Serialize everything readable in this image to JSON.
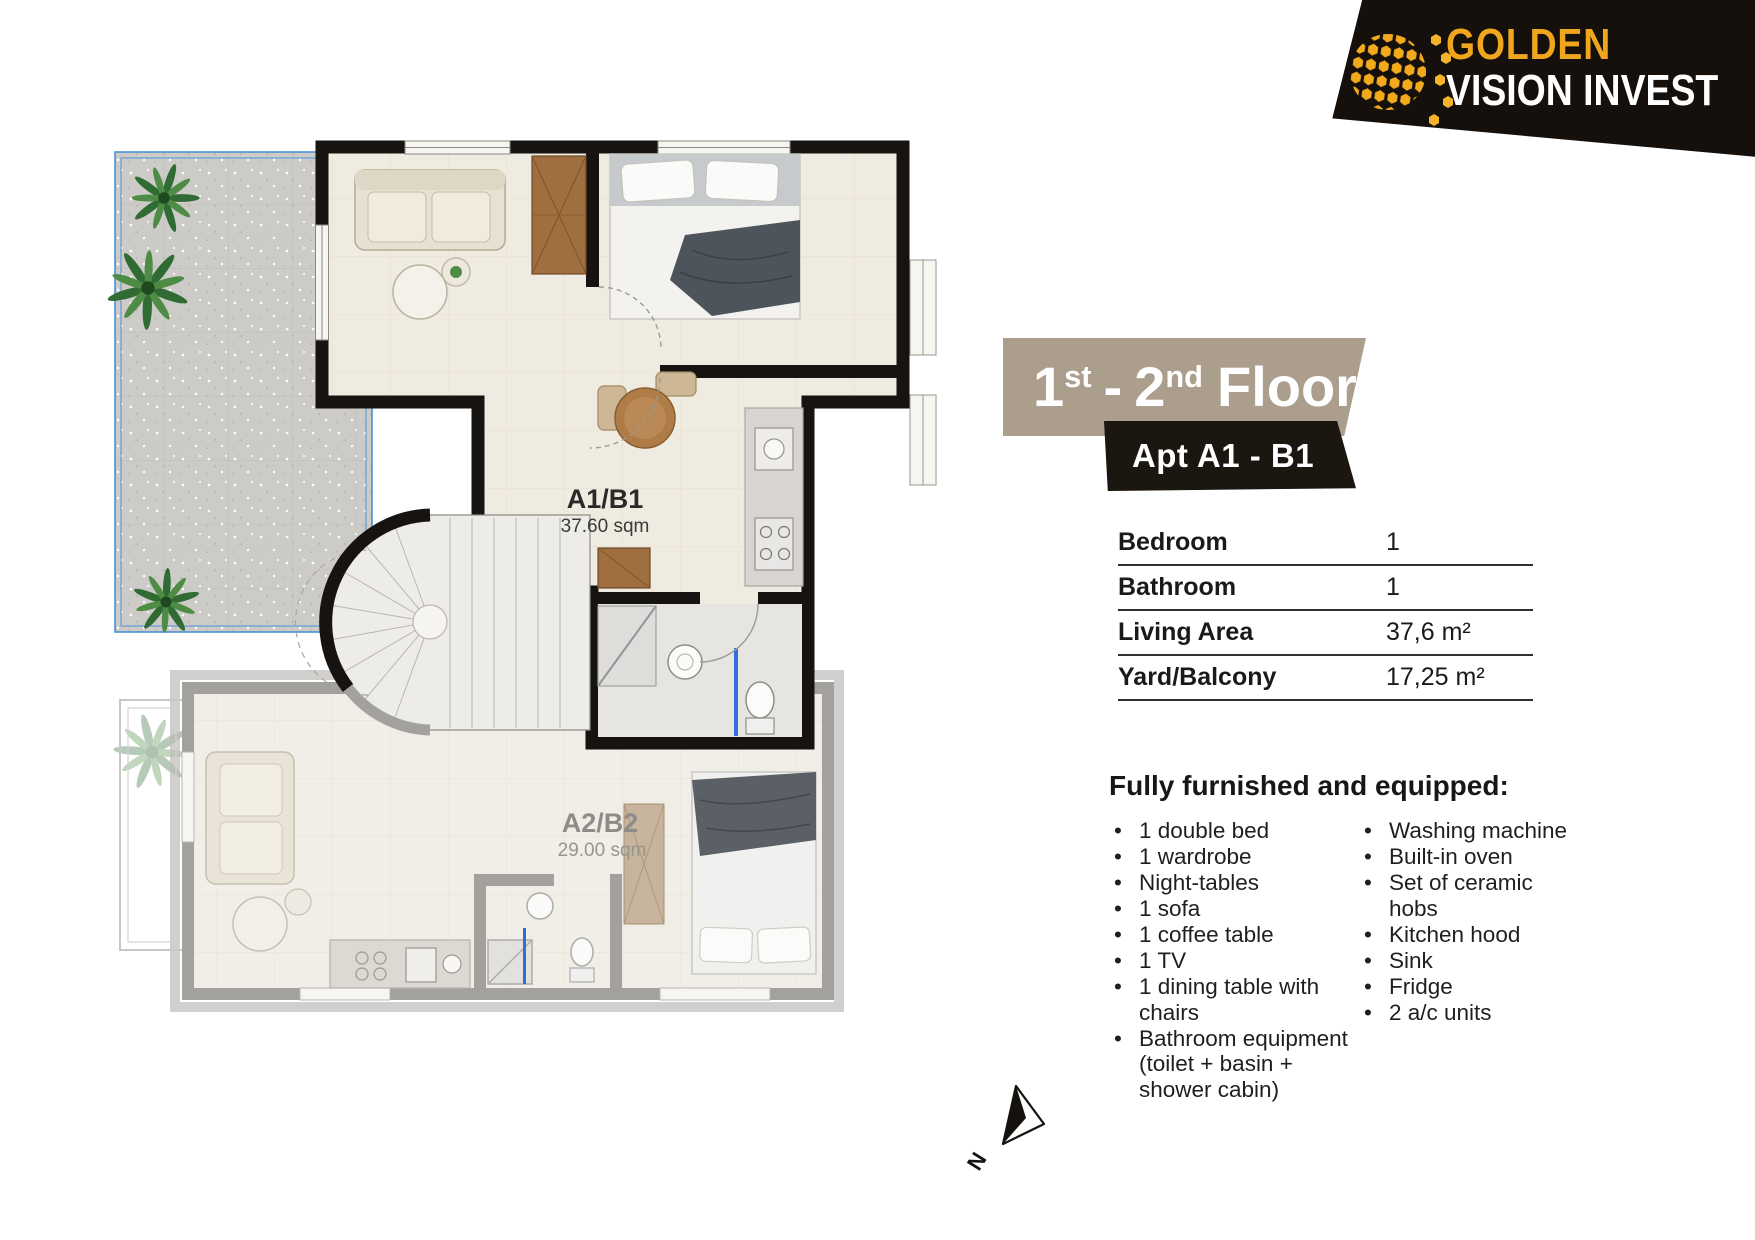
{
  "logo": {
    "word1": "GOLDEN",
    "word2": "VISION INVEST",
    "icon": "hex-globe-icon"
  },
  "banner": {
    "num1": "1",
    "sup1": "st",
    "sep": "-",
    "num2": "2",
    "sup2": "nd",
    "word": "Floor"
  },
  "badge": {
    "label": "Apt A1 - B1"
  },
  "specs": {
    "rows": [
      {
        "label": "Bedroom",
        "value": "1"
      },
      {
        "label": "Bathroom",
        "value": "1"
      },
      {
        "label": "Living Area",
        "value": "37,6 m²"
      },
      {
        "label": "Yard/Balcony",
        "value": "17,25 m²"
      }
    ]
  },
  "furnished": {
    "heading": "Fully furnished and equipped:",
    "left_items": [
      "1 double bed",
      "1 wardrobe",
      "Night-tables",
      "1 sofa",
      "1 coffee table",
      "1 TV",
      "1 dining table with chairs",
      "Bathroom equipment (toilet + basin + shower cabin)"
    ],
    "right_items": [
      "Washing machine",
      "Built-in oven",
      "Set of ceramic hobs",
      "Kitchen hood",
      "Sink",
      "Fridge",
      "2 a/c units"
    ]
  },
  "floorplan": {
    "unit1_label": "A1/B1",
    "unit1_area": "37.60 sqm",
    "unit2_label": "A2/B2",
    "unit2_area": "29.00 sqm",
    "compass_label": "N"
  },
  "colors": {
    "banner_bg": "#AC9E8D",
    "badge_bg": "#1C1611",
    "logo_bg": "#15100B",
    "gold": "#EFA51E",
    "accent_blue": "#2F6ED6",
    "wall_black": "#161310",
    "unit2_gray": "#A3A19E"
  }
}
